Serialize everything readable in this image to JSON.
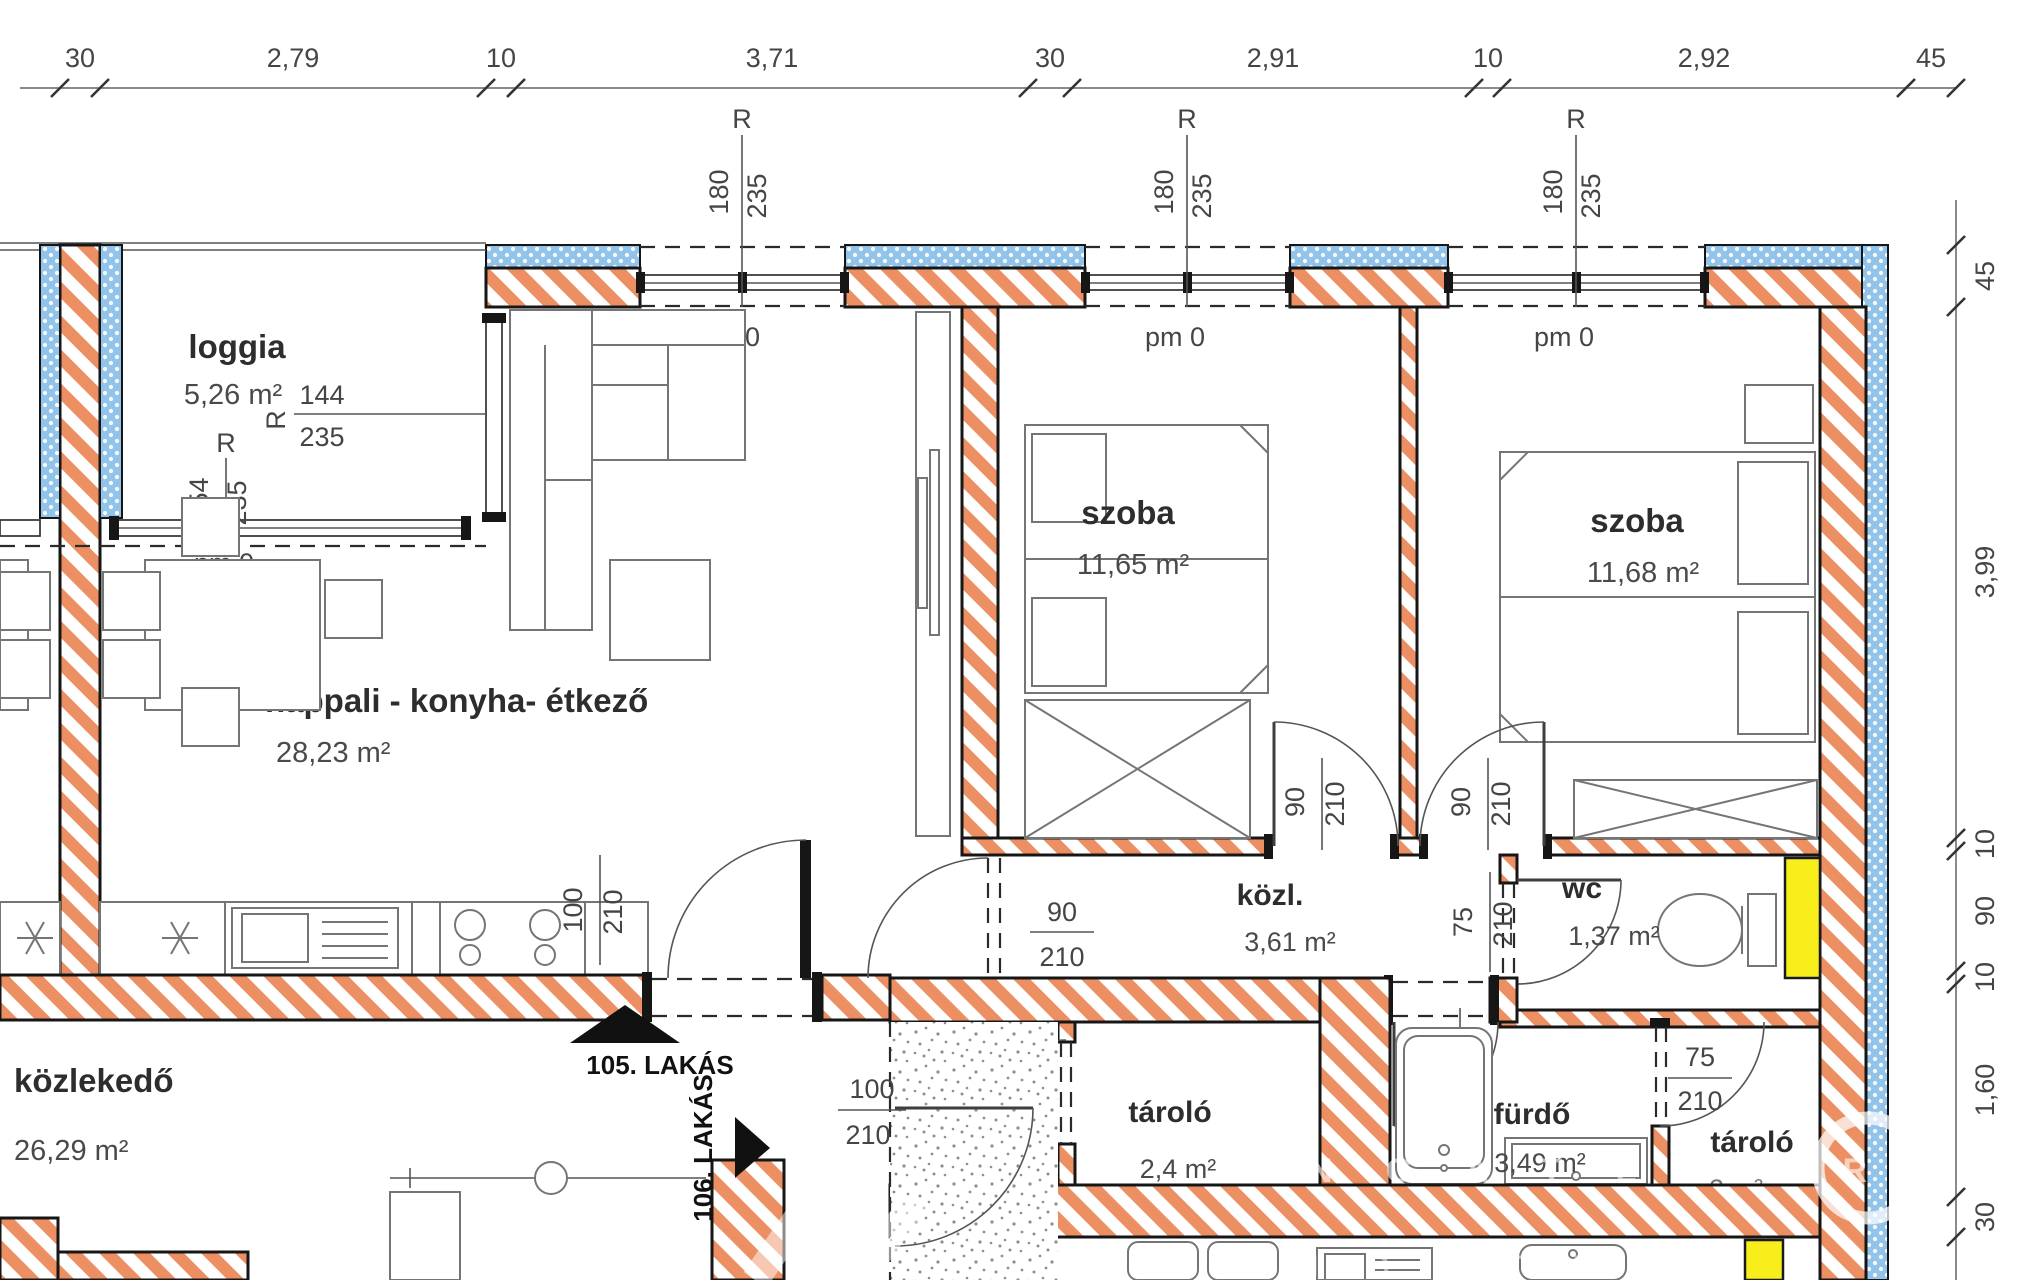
{
  "rooms": {
    "loggia": {
      "name": "loggia",
      "area": "5,26 m²"
    },
    "nappali": {
      "name": "nappali - konyha- étkező",
      "area": "28,23 m²"
    },
    "szoba1": {
      "name": "szoba",
      "area": "11,65 m²"
    },
    "szoba2": {
      "name": "szoba",
      "area": "11,68 m²"
    },
    "kozl": {
      "name": "közl.",
      "area": "3,61 m²"
    },
    "wc": {
      "name": "wc",
      "area": "1,37 m²"
    },
    "kozlekedo": {
      "name": "közlekedő",
      "area": "26,29 m²"
    },
    "tarolo1": {
      "name": "tároló",
      "area": "2,4 m²"
    },
    "furdo": {
      "name": "fürdő",
      "area": "3,49 m²"
    },
    "tarolo2": {
      "name": "tároló",
      "area": "2 m²"
    }
  },
  "dimensions": {
    "top": [
      "30",
      "2,79",
      "10",
      "3,71",
      "30",
      "2,91",
      "10",
      "2,92",
      "45"
    ],
    "right": [
      "45",
      "3,99",
      "10",
      "90",
      "10",
      "1,60",
      "30"
    ]
  },
  "openings": {
    "r": "R",
    "pm0": "pm 0",
    "w180": "180",
    "w254": "254",
    "w144": "144",
    "h235": "235",
    "d100": "100",
    "d90": "90",
    "d75": "75",
    "dh": "210"
  },
  "apartments": {
    "a105": "105. LAKÁS",
    "a106": "106. LAKÁS"
  },
  "watermark": {
    "row1": "I N G A T L A N  R",
    "row2": "I N G A T L A N"
  },
  "colors": {
    "wall_hatch": "#EC8F63",
    "insulation_hatch": "#8FBFE8",
    "shaft": "#F8EE1C"
  }
}
